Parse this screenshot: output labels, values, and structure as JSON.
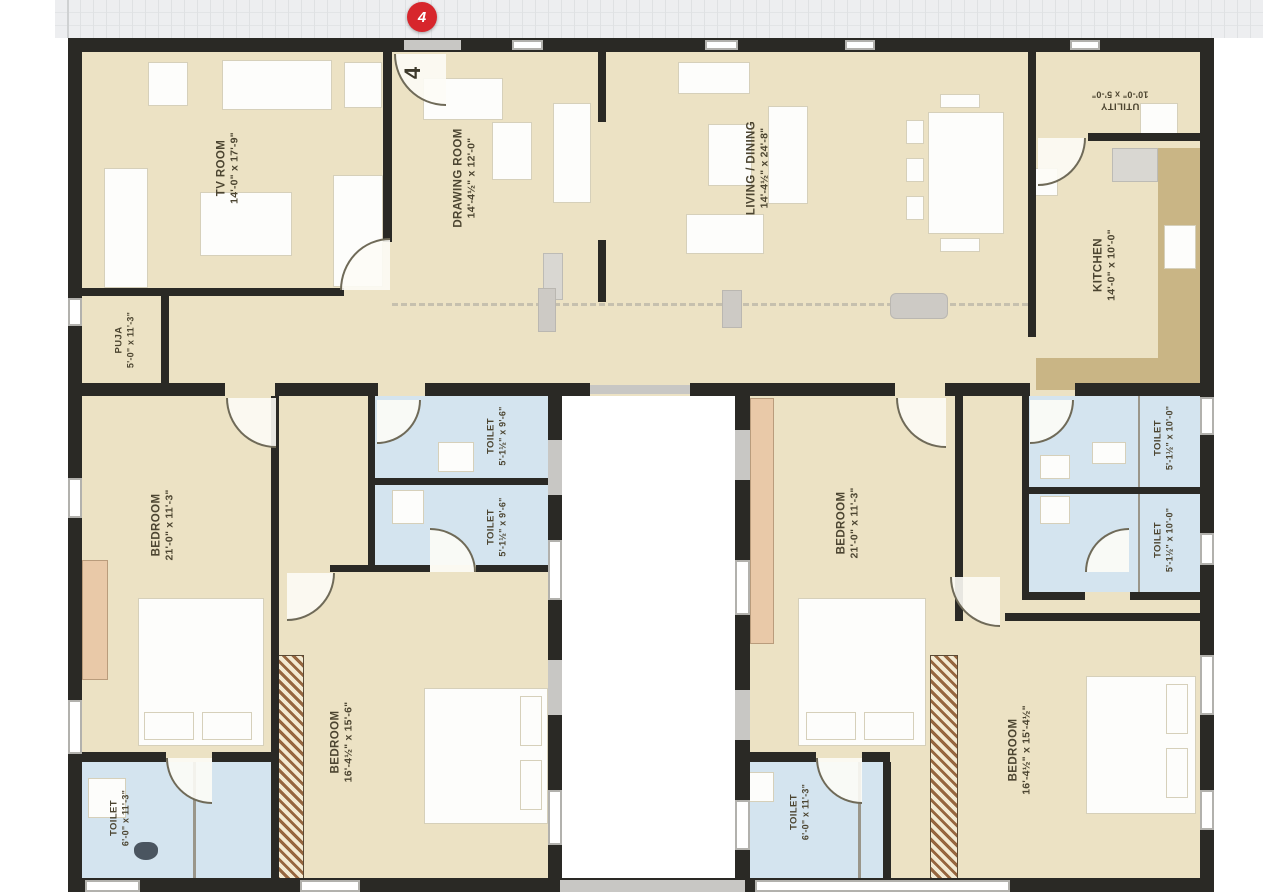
{
  "top_bar": {
    "marker_label": "4"
  },
  "unit": {
    "label": "4"
  },
  "rooms": {
    "tv_room": {
      "name": "TV ROOM",
      "dims": "14'-0\" x 17'-9\""
    },
    "drawing_room": {
      "name": "DRAWING ROOM",
      "dims": "14'-4½\" x 12'-0\""
    },
    "living_dining": {
      "name": "LIVING / DINING",
      "dims": "14'-4½\" x 24'-8\""
    },
    "utility": {
      "name": "UTILITY",
      "dims": "10'-0\" x 5'-0\""
    },
    "kitchen": {
      "name": "KITCHEN",
      "dims": "14'-0\" x 10'-0\""
    },
    "puja": {
      "name": "PUJA",
      "dims": "5'-0\" x 11'-3\""
    },
    "bedroom_left": {
      "name": "BEDROOM",
      "dims": "21'-0\" x 11'-3\""
    },
    "toilet_left_top": {
      "name": "TOILET",
      "dims": "5'-1½\" x 9'-6\""
    },
    "toilet_left_bottom": {
      "name": "TOILET",
      "dims": "5'-1½\" x 9'-6\""
    },
    "bedroom_left_bottom": {
      "name": "BEDROOM",
      "dims": "16'-4½\" x 15'-6\""
    },
    "toilet_bottom_left": {
      "name": "TOILET",
      "dims": "6'-0\" x 11'-3\""
    },
    "bedroom_right": {
      "name": "BEDROOM",
      "dims": "21'-0\" x 11'-3\""
    },
    "toilet_right_top": {
      "name": "TOILET",
      "dims": "5'-1½\" x 10'-0\""
    },
    "toilet_right_bottom": {
      "name": "TOILET",
      "dims": "5'-1½\" x 10'-0\""
    },
    "bedroom_right_bottom": {
      "name": "BEDROOM",
      "dims": "16'-4½\" x 15'-4½\""
    },
    "toilet_bottom_right": {
      "name": "TOILET",
      "dims": "6'-0\" x 11'-3\""
    }
  },
  "colors": {
    "floor_beige": "#ece2c4",
    "toilet_blue": "#d4e4ef",
    "wall_black": "#2a2925",
    "window_gray": "#c8c7c4",
    "counter_tan": "#c9b585",
    "wardrobe_peach": "#e9c9a8",
    "hatch_brown": "#96663f",
    "marker_red": "#d7262c",
    "label_olive": "#4c4531",
    "top_strip": "#edeef0"
  }
}
